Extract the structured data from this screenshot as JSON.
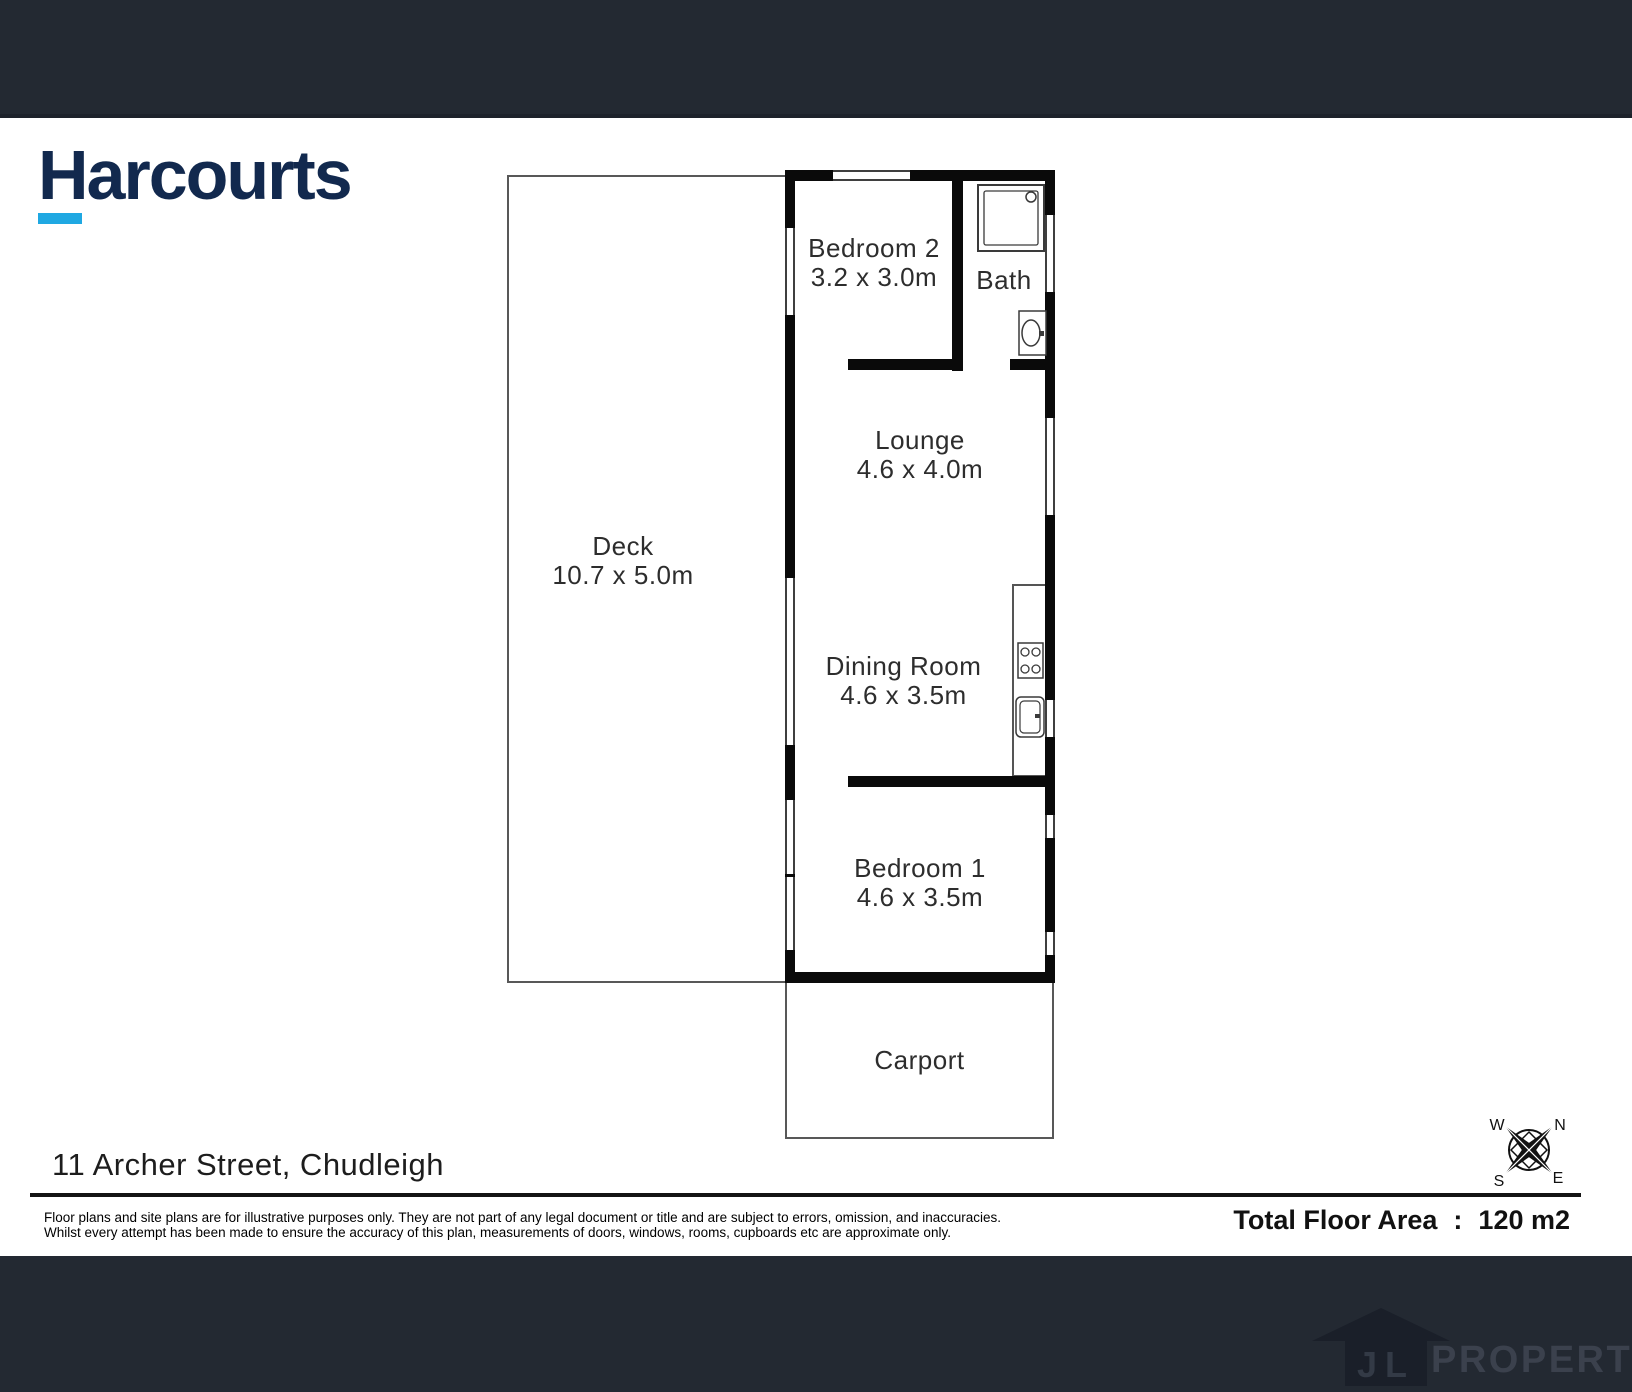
{
  "brand": {
    "name": "Harcourts"
  },
  "rooms": {
    "bedroom2": {
      "name": "Bedroom 2",
      "dims": "3.2 x 3.0m"
    },
    "bath": {
      "name": "Bath"
    },
    "lounge": {
      "name": "Lounge",
      "dims": "4.6 x 4.0m"
    },
    "dining": {
      "name": "Dining Room",
      "dims": "4.6 x 3.5m"
    },
    "bedroom1": {
      "name": "Bedroom 1",
      "dims": "4.6 x 3.5m"
    },
    "deck": {
      "name": "Deck",
      "dims": "10.7 x 5.0m"
    },
    "carport": {
      "name": "Carport"
    }
  },
  "compass": {
    "n": "N",
    "e": "E",
    "s": "S",
    "w": "W"
  },
  "footer": {
    "address": "11 Archer Street, Chudleigh",
    "disclaimer_line1": "Floor plans and site plans are for illustrative purposes only. They are not part of any legal document or title and are subject to errors, omission, and inaccuracies.",
    "disclaimer_line2": "Whilst every attempt has been made to ensure the accuracy of this plan, measurements of doors, windows, rooms, cupboards etc are approximate only.",
    "total_area_label": "Total Floor Area",
    "total_area_separator": ":",
    "total_area_value": "120 m2"
  },
  "brand_footer": {
    "initials": "JL",
    "name": "PROPERTY"
  },
  "colors": {
    "brand_navy": "#12294e",
    "accent_cyan": "#1fa8e2",
    "band_dark": "#232932",
    "wall_black": "#0a0a0a"
  }
}
